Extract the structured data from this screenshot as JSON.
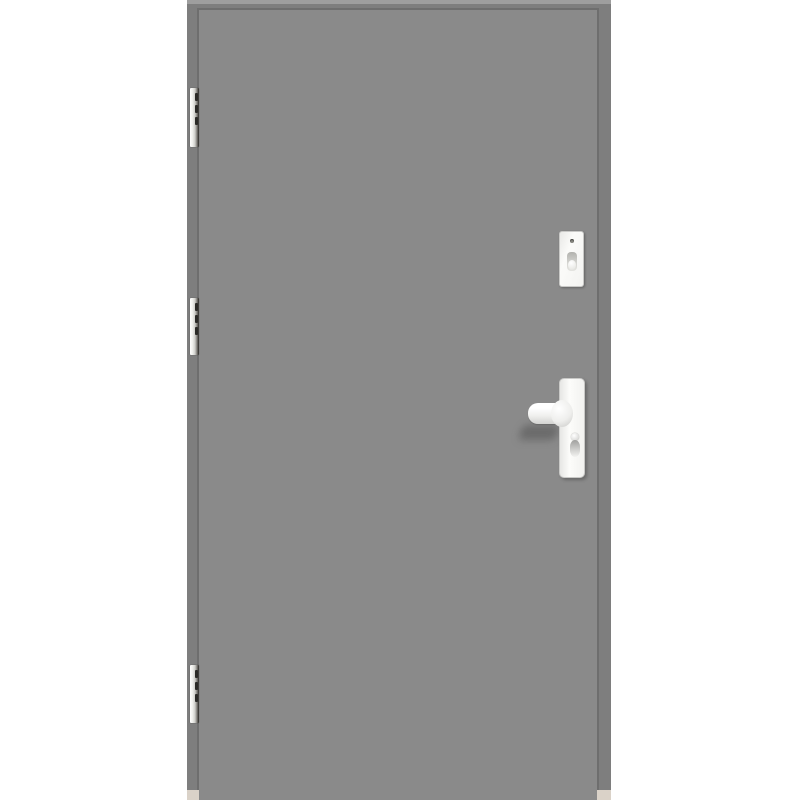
{
  "scene": {
    "type": "product-photo",
    "subject": "Closed gray exterior door on a white background, hinged on the left with three hinges, with a white lever handle on a long backplate and a separate lock cylinder escutcheon above it",
    "door_leaf_label": "door-leaf",
    "door_frame_label": "door-frame"
  },
  "colors": {
    "background": "#ffffff",
    "door_frame": "#7e7e7e",
    "door_leaf": "#8a8a8a",
    "frame_seam": "#6e6e6e",
    "frame_top_highlight": "#9e9e9e",
    "hardware_white": "#f7f7f5",
    "hardware_border": "#c9c9c7",
    "hinge_light": "#f0f0ec",
    "hinge_dark": "#2e2c29",
    "threshold_cut": "#dad2c8"
  },
  "parts": {
    "hinges": [
      {
        "label": "top-hinge"
      },
      {
        "label": "middle-hinge"
      },
      {
        "label": "bottom-hinge"
      }
    ],
    "cylinder_plate": {
      "label": "lock-cylinder-escutcheon",
      "details": [
        "screw",
        "key-cover"
      ]
    },
    "handle": {
      "label": "lever-handle",
      "details": [
        "backplate",
        "lever",
        "euro-cylinder"
      ]
    },
    "jamb_cuts": [
      {
        "label": "left-frame-floor-cut"
      },
      {
        "label": "right-frame-floor-cut"
      }
    ]
  }
}
